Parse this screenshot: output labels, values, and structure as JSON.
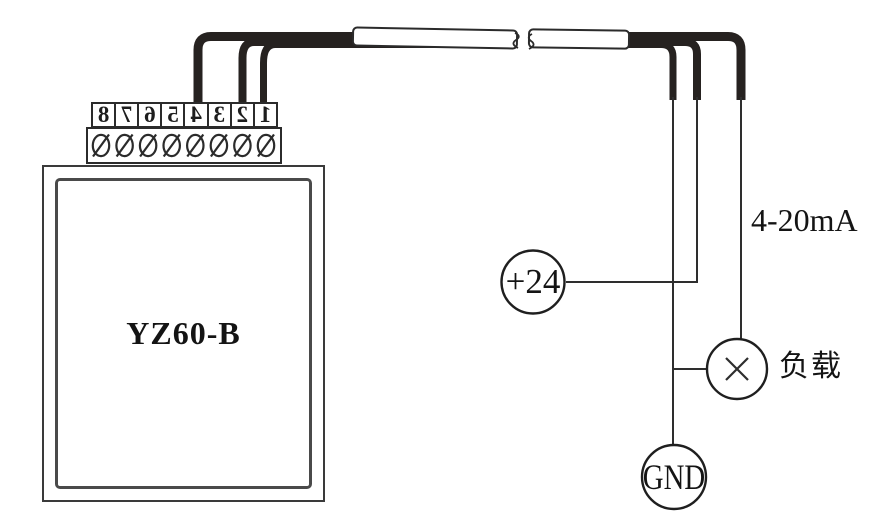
{
  "device": {
    "model_label": "YZ60-B"
  },
  "terminal_block": {
    "numbers": [
      "1",
      "2",
      "3",
      "4",
      "5",
      "6",
      "7",
      "8"
    ]
  },
  "nodes": {
    "power_label": "+24",
    "ground_label": "GND",
    "load_label": "负载",
    "current_range_label": "4-20mA"
  },
  "colors": {
    "thin_wire": "#2e2e2e",
    "thick_cable": "#262220",
    "outline": "#2b2b2b",
    "device_outline": "#3a3a3a",
    "background": "#ffffff"
  }
}
